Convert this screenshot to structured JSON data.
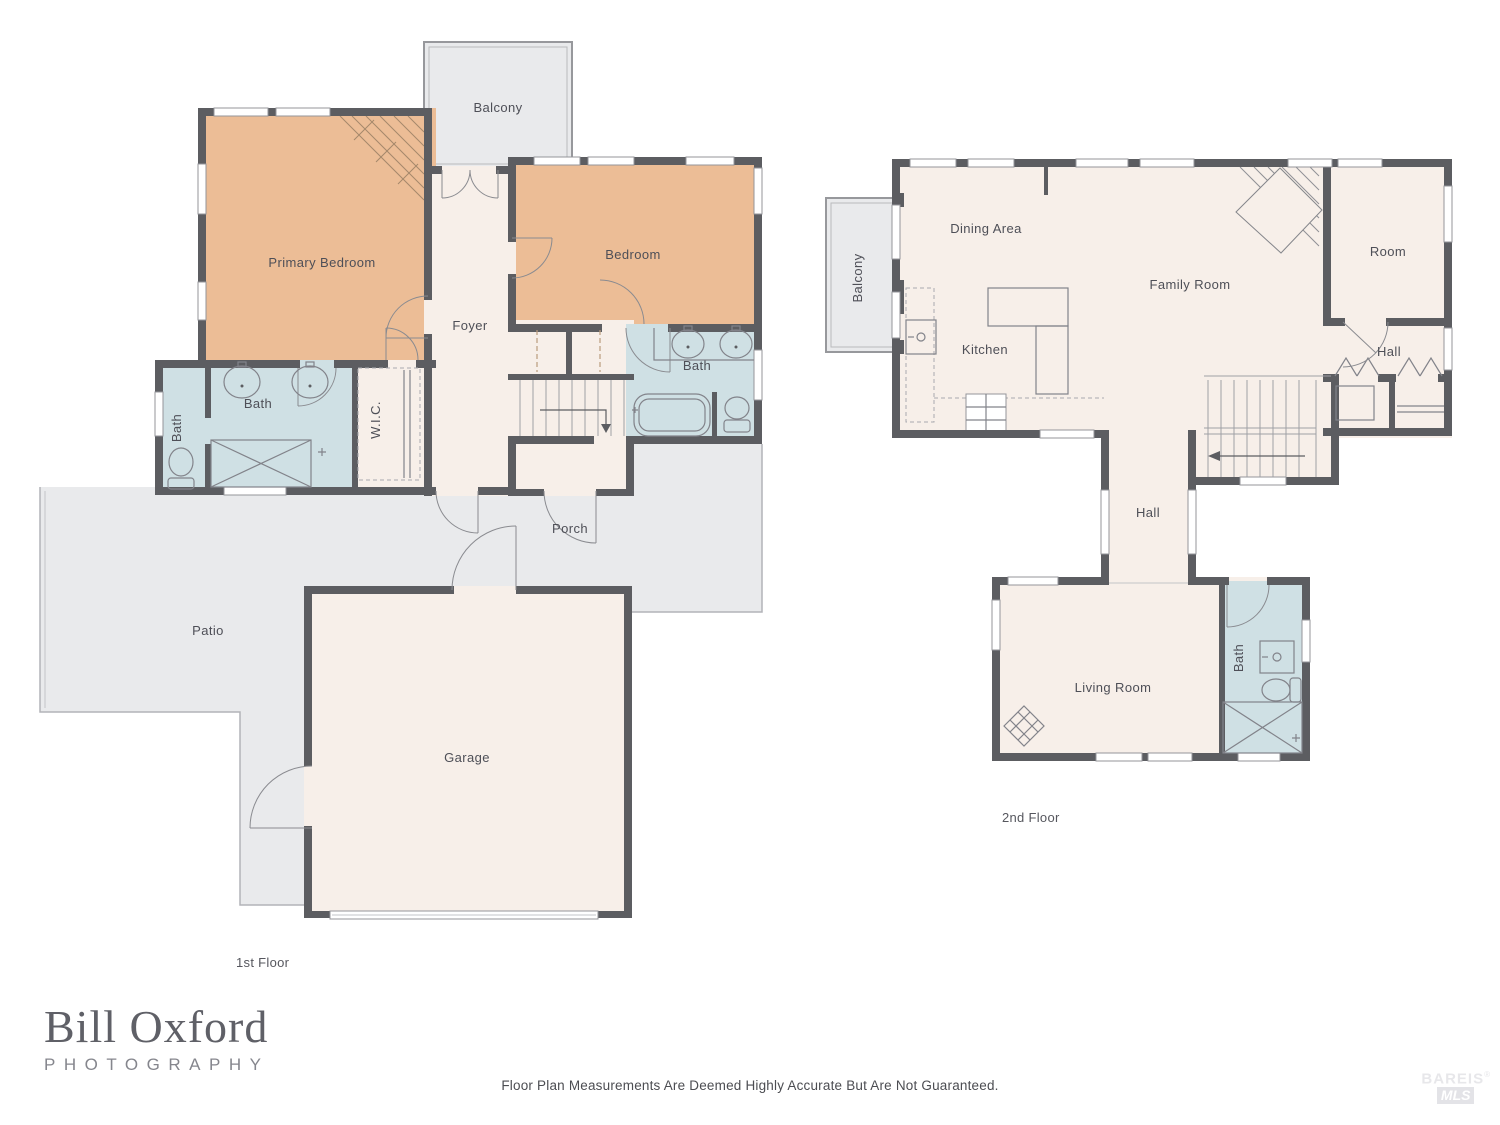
{
  "floor1": {
    "label": "1st Floor",
    "rooms": {
      "balcony": "Balcony",
      "primary_bedroom": "Primary Bedroom",
      "foyer": "Foyer",
      "bedroom": "Bedroom",
      "bath_main": "Bath",
      "bath_small": "Bath",
      "bath_ensuite": "Bath",
      "wic": "W.I.C.",
      "porch": "Porch",
      "patio": "Patio",
      "garage": "Garage"
    }
  },
  "floor2": {
    "label": "2nd Floor",
    "rooms": {
      "balcony": "Balcony",
      "dining_area": "Dining Area",
      "kitchen": "Kitchen",
      "family_room": "Family Room",
      "room": "Room",
      "hall_upper": "Hall",
      "hall": "Hall",
      "living_room": "Living Room",
      "bath": "Bath"
    }
  },
  "branding": {
    "logo_name": "Bill Oxford",
    "logo_subtitle": "PHOTOGRAPHY"
  },
  "footer": {
    "disclaimer": "Floor Plan Measurements Are Deemed Highly Accurate But Are Not Guaranteed."
  },
  "watermark": {
    "name": "BAREIS",
    "reg": "®",
    "sub": "MLS"
  },
  "colors": {
    "wall": "#5c5d61",
    "bedroom_fill": "#ecbd96",
    "interior_fill": "#f7efe9",
    "bath_fill": "#cfe0e4",
    "outdoor_fill": "#e9eaec",
    "label_text": "#4e4f57"
  }
}
